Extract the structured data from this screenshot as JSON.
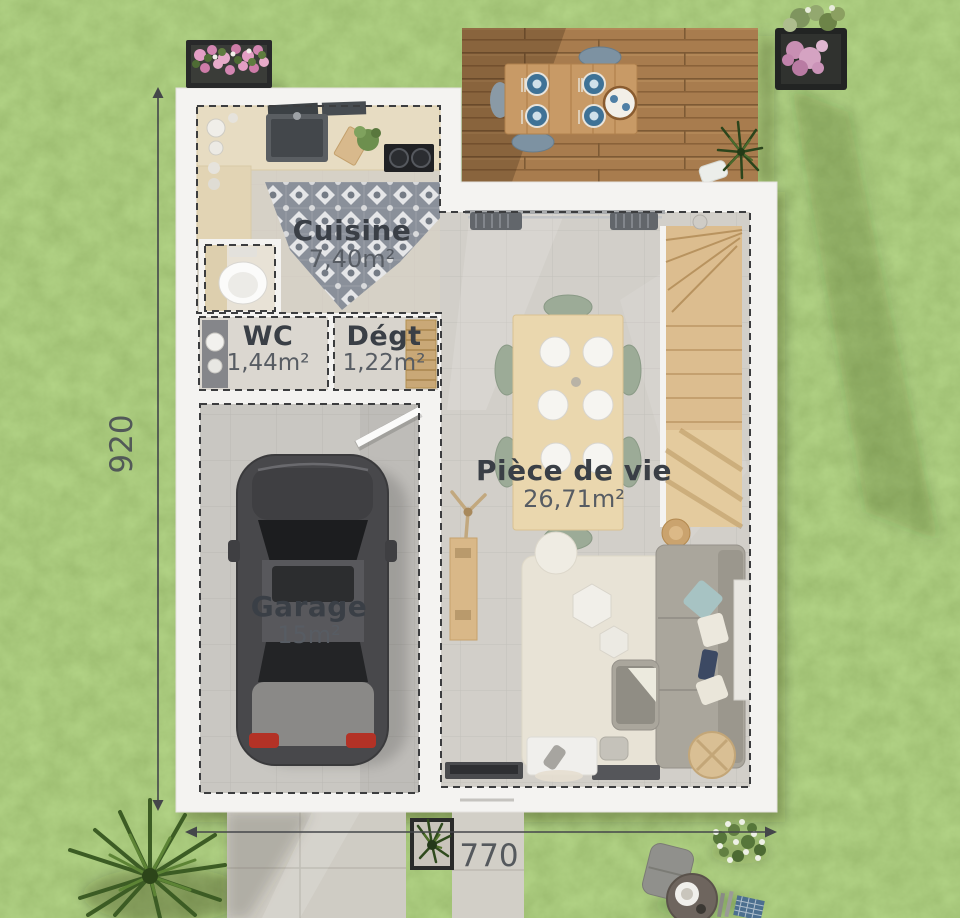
{
  "plan": {
    "rooms": [
      {
        "name": "Cuisine",
        "area": "7,40m²"
      },
      {
        "name": "WC",
        "area": "1,44m²"
      },
      {
        "name": "Dégt",
        "area": "1,22m²"
      },
      {
        "name": "Pièce de vie",
        "area": "26,71m²"
      },
      {
        "name": "Garage",
        "area": "15m²"
      }
    ],
    "dimensions": {
      "height_cm": "920",
      "width_cm": "770"
    }
  },
  "colors": {
    "grass": "#74a345",
    "deck_wood": "#a87c4e",
    "house_wall": "#f4f3f1",
    "floor": "#d2cfc9",
    "label_text": "#3a3f46",
    "dimension_text": "#4b5055"
  }
}
